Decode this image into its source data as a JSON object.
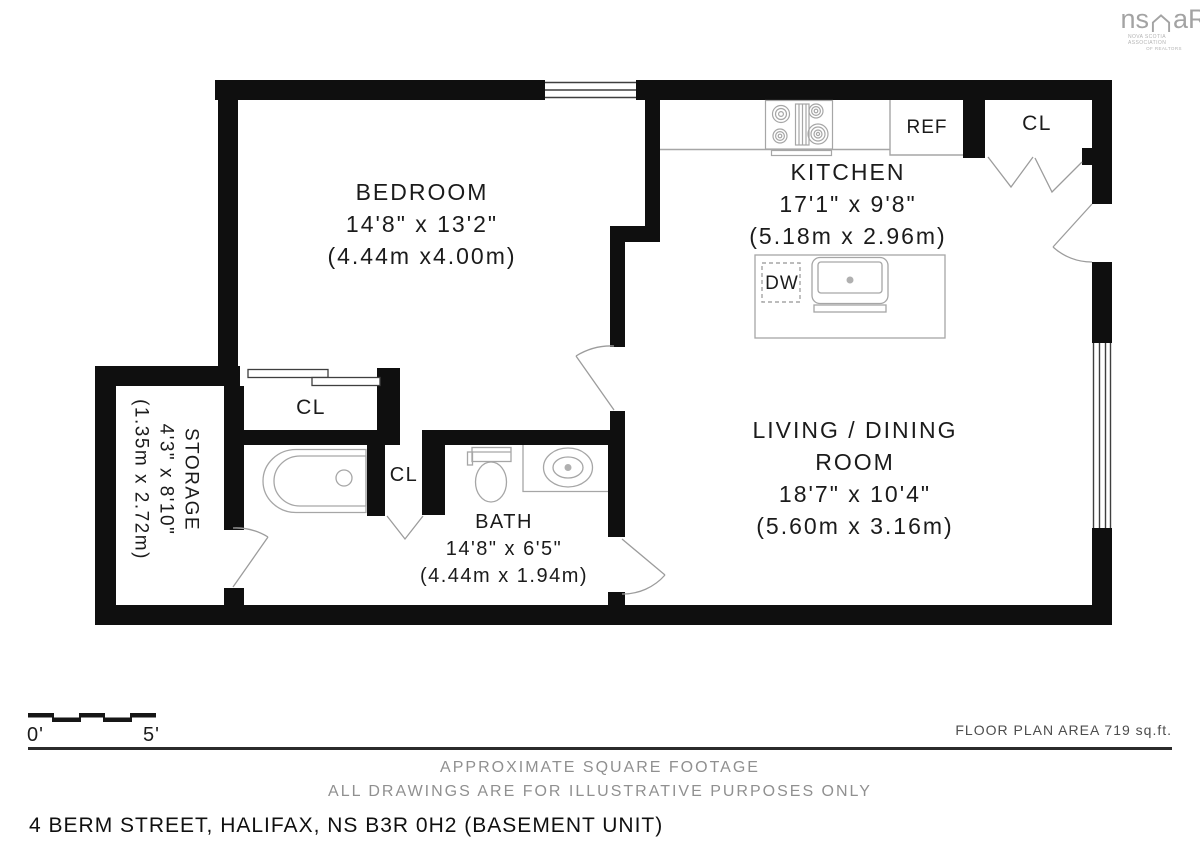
{
  "colors": {
    "wall": "#0f0f0f",
    "fixture_line": "#a6a6a6",
    "door_line": "#9c9c9c",
    "window_line": "#3f3f3f",
    "text": "#1b1b1b",
    "muted_text": "#909090",
    "area_text": "#4d4d4d",
    "logo_gray": "#a3a3a3"
  },
  "logo": {
    "left": "ns",
    "right": "aR",
    "caption1": "NOVA SCOTIA ASSOCIATION",
    "caption2": "OF REALTORS"
  },
  "rooms": {
    "bedroom": {
      "name": "BEDROOM",
      "imperial": "14'8\" x 13'2\"",
      "metric": "(4.44m x4.00m)"
    },
    "kitchen": {
      "name": "KITCHEN",
      "imperial": "17'1\" x 9'8\"",
      "metric": "(5.18m x 2.96m)"
    },
    "living": {
      "name1": "LIVING / DINING",
      "name2": "ROOM",
      "imperial": "18'7\" x 10'4\"",
      "metric": "(5.60m x 3.16m)"
    },
    "bath": {
      "name": "BATH",
      "imperial": "14'8\" x 6'5\"",
      "metric": "(4.44m x 1.94m)"
    },
    "storage": {
      "name": "STORAGE",
      "imperial": "4'3\" x 8'10\"",
      "metric": "(1.35m x 2.72m)"
    }
  },
  "fixtures": {
    "closet_bedroom": "CL",
    "closet_hall": "CL",
    "closet_entry": "CL",
    "refrigerator": "REF",
    "dishwasher": "DW"
  },
  "scale_bar": {
    "start": "0'",
    "end": "5'"
  },
  "footer": {
    "area": "FLOOR PLAN AREA 719 sq.ft.",
    "note1": "APPROXIMATE SQUARE FOOTAGE",
    "note2": "ALL DRAWINGS ARE FOR ILLUSTRATIVE PURPOSES ONLY",
    "address": "4 BERM STREET, HALIFAX, NS B3R 0H2 (BASEMENT UNIT)"
  }
}
